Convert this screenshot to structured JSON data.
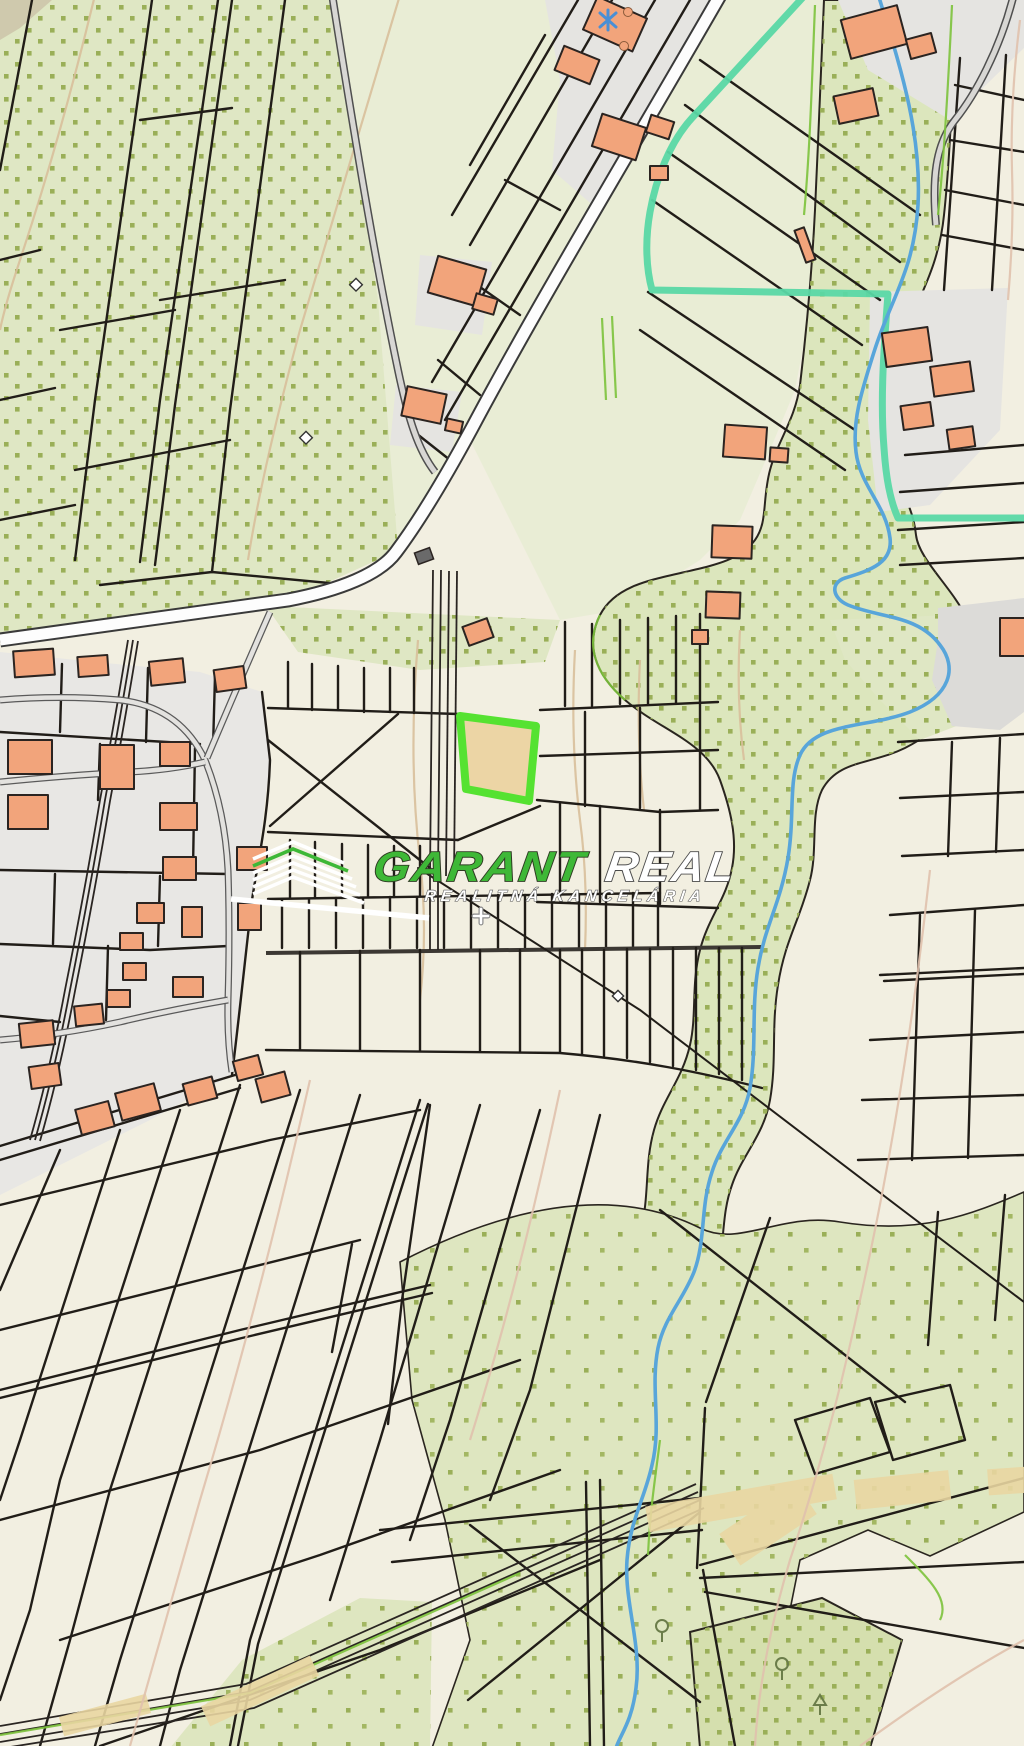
{
  "page": {
    "title": "Cadastral map with highlighted parcel"
  },
  "watermark": {
    "brand_primary": "GARANT",
    "brand_secondary": "REAL",
    "tagline": "REALITNÁ KANCELÁRIA",
    "logo_icon": "roof-chevrons-icon",
    "colors": {
      "primary_green": "#3eb837",
      "text_white": "#ffffff",
      "outline_dark": "#2e3b22",
      "outline_grey": "#4a4a4a"
    }
  },
  "map": {
    "kind": "cadastral-map",
    "highlighted_parcel": {
      "points": "460,716 536,726 529,801 466,789",
      "fill": "#ecd5a5",
      "stroke": "#55e231"
    },
    "palette": {
      "paper": "#f2efe1",
      "field_green": "#dfe7c4",
      "field_green_light": "#e9edd5",
      "dot_green": "#9aaf58",
      "urban_grey": "#e7e6e3",
      "road_grey": "#d8d7d4",
      "building_orange": "#f2a47b",
      "building_outline": "#2b2421",
      "parcel_line": "#211d18",
      "road_white": "#fdfdfd",
      "stream_blue": "#58a5da",
      "boundary_teal": "#5ad8a5",
      "contour_tan": "#d8bf9b",
      "contour_pink": "#e0c1ad",
      "track_tan": "#e9d6a2"
    }
  }
}
